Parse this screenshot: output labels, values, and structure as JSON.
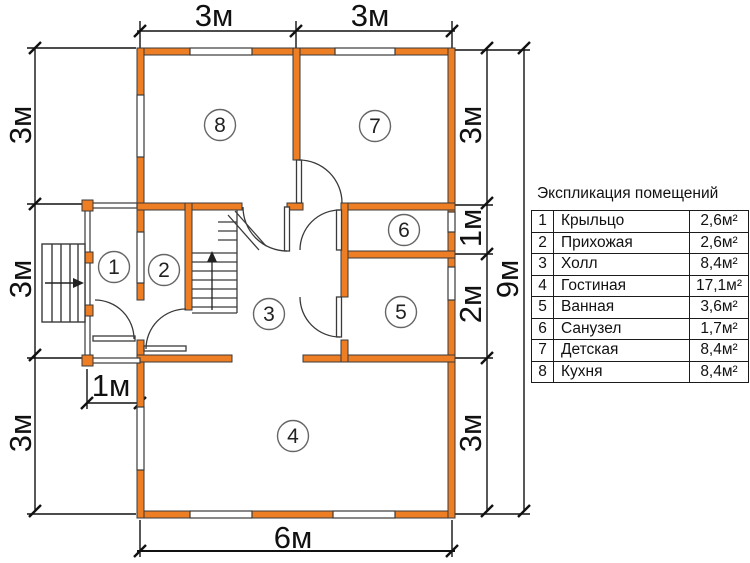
{
  "colors": {
    "wall": "#ED7E23",
    "line": "#333333",
    "dim": "#111111"
  },
  "dimensions": {
    "top": [
      "3м",
      "3м"
    ],
    "bottom_width": "6м",
    "left": [
      "3м",
      "3м",
      "3м"
    ],
    "right": [
      "3м",
      "1м",
      "2м",
      "3м"
    ],
    "total_height": "9м",
    "porch_width": "1м"
  },
  "plan": {
    "room_numbers": [
      "1",
      "2",
      "3",
      "4",
      "5",
      "6",
      "7",
      "8"
    ]
  },
  "legend": {
    "title": "Экспликация помещений",
    "rows": [
      {
        "num": "1",
        "name": "Крыльцо",
        "area": "2,6м²"
      },
      {
        "num": "2",
        "name": "Прихожая",
        "area": "2,6м²"
      },
      {
        "num": "3",
        "name": "Холл",
        "area": "8,4м²"
      },
      {
        "num": "4",
        "name": "Гостиная",
        "area": "17,1м²"
      },
      {
        "num": "5",
        "name": "Ванная",
        "area": "3,6м²"
      },
      {
        "num": "6",
        "name": "Санузел",
        "area": "1,7м²"
      },
      {
        "num": "7",
        "name": "Детская",
        "area": "8,4м²"
      },
      {
        "num": "8",
        "name": "Кухня",
        "area": "8,4м²"
      }
    ]
  }
}
